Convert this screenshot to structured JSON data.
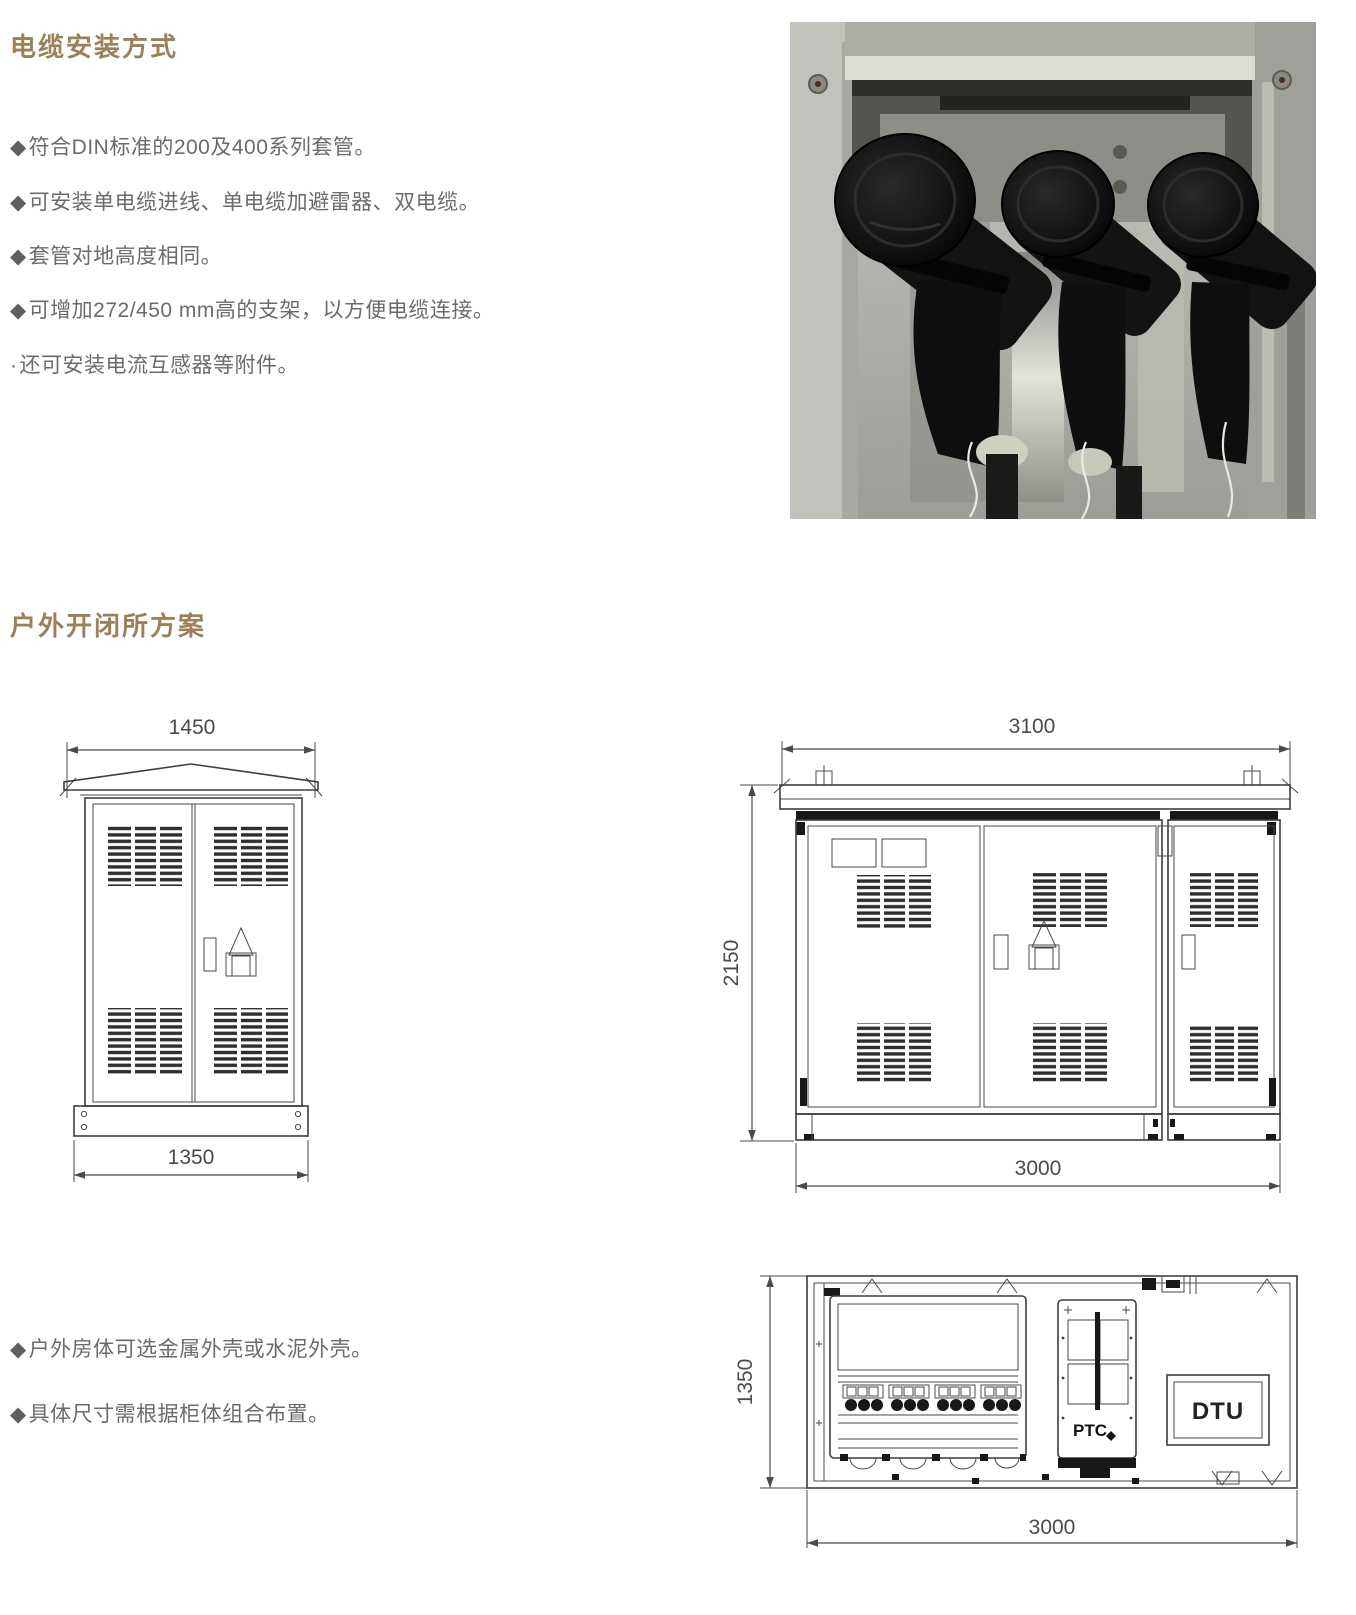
{
  "colors": {
    "title": "#9d8056",
    "body_text": "#6b6b6b",
    "drawing_line": "#3d3d3d"
  },
  "section_cable": {
    "title": "电缆安装方式",
    "bullets": [
      {
        "marker": "◆",
        "text": "符合DIN标准的200及400系列套管。"
      },
      {
        "marker": "◆",
        "text": "可安装单电缆进线、单电缆加避雷器、双电缆。"
      },
      {
        "marker": "◆",
        "text": "套管对地高度相同。"
      },
      {
        "marker": "◆",
        "text": "可增加272/450 mm高的支架，以方便电缆连接。"
      },
      {
        "marker": "·",
        "text": "还可安装电流互感器等附件。"
      }
    ],
    "photo_caption": "cabinet-interior-with-three-cable-elbow-terminations"
  },
  "section_outdoor": {
    "title": "户外开闭所方案",
    "bullets": [
      {
        "marker": "◆",
        "text": "户外房体可选金属外壳或水泥外壳。"
      },
      {
        "marker": "◆",
        "text": "具体尺寸需根据柜体组合布置。"
      }
    ],
    "drawings": {
      "small_cabinet": {
        "dim_top": "1450",
        "dim_bottom": "1350"
      },
      "large_cabinet": {
        "dim_top": "3100",
        "dim_left": "2150",
        "dim_bottom": "3000"
      },
      "plan_view": {
        "dim_left": "1350",
        "dim_bottom": "3000",
        "label_ptc": "PTC",
        "label_dtu": "DTU"
      }
    }
  }
}
